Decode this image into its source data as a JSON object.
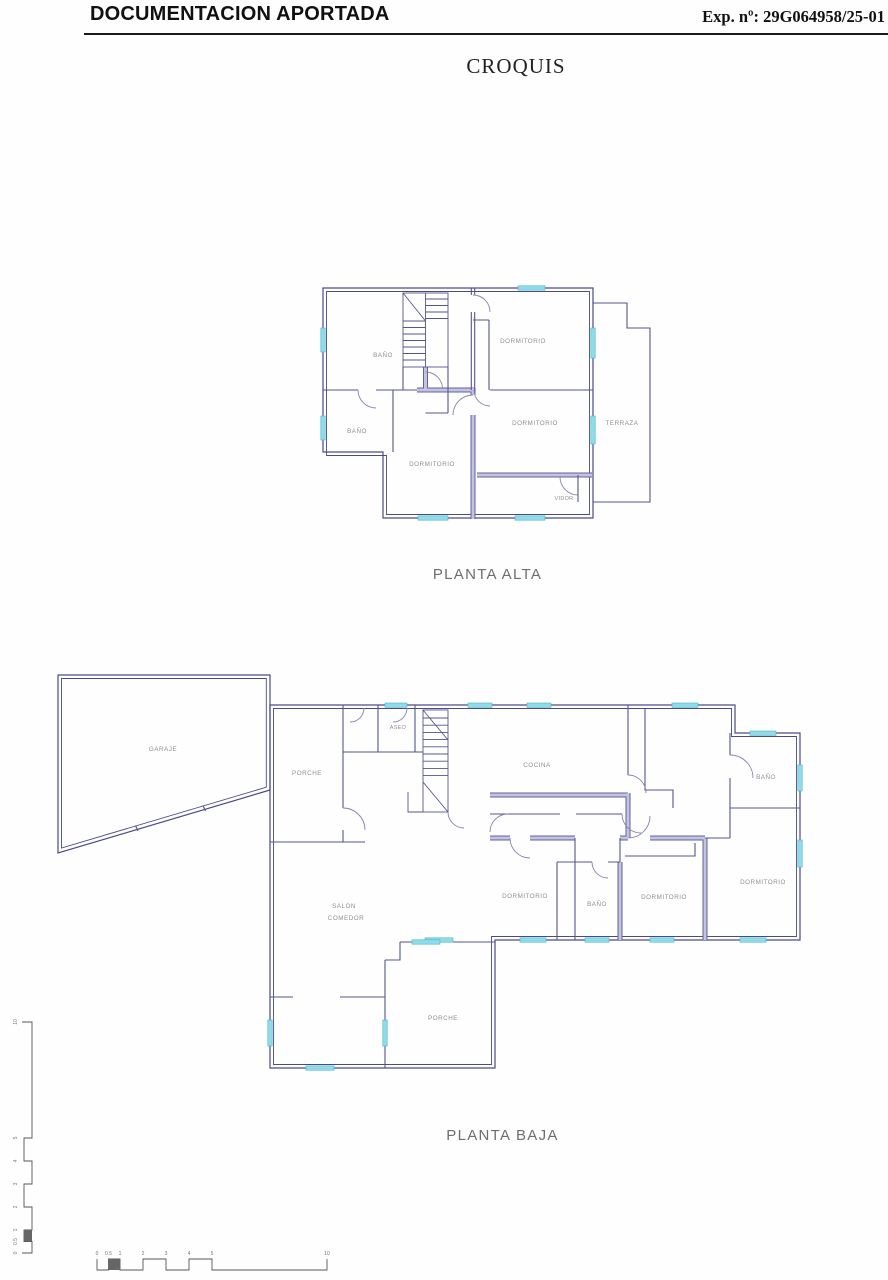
{
  "header": {
    "title": "DOCUMENTACION APORTADA",
    "exp": "Exp. nº: 29G064958/25-01"
  },
  "doc_title": "CROQUIS",
  "planta_alta": {
    "caption": "PLANTA ALTA",
    "rooms": {
      "bano_top": "BAÑO",
      "dormitorio_top": "DORMITORIO",
      "bano_mid": "BAÑO",
      "dormitorio_center": "DORMITORIO",
      "dormitorio_right": "DORMITORIO",
      "terraza": "TERRAZA",
      "vidor": "VIDOR"
    }
  },
  "planta_baja": {
    "caption": "PLANTA BAJA",
    "rooms": {
      "garaje": "GARAJE",
      "porche_top": "PORCHE",
      "aseo": "ASEO",
      "cocina": "COCINA",
      "bano_top": "BAÑO",
      "salon_line1": "SALON",
      "salon_line2": "COMEDOR",
      "dormitorio_left": "DORMITORIO",
      "bano_mid": "BAÑO",
      "dormitorio_center": "DORMITORIO",
      "dormitorio_right": "DORMITORIO",
      "porche_bottom": "PORCHE"
    }
  },
  "scale_bar": {
    "vertical_labels": [
      "10",
      "5",
      "4",
      "3",
      "2",
      "1",
      "0.5",
      "0"
    ],
    "horizontal_labels": [
      "0",
      "0.5",
      "1",
      "2",
      "3",
      "4",
      "5",
      "10"
    ]
  },
  "colors": {
    "wall_dark": "#4b4b8a",
    "wall_light": "#c3c3e4",
    "window_cyan": "#8fdbe8",
    "label_gray": "#8f8f8f"
  }
}
